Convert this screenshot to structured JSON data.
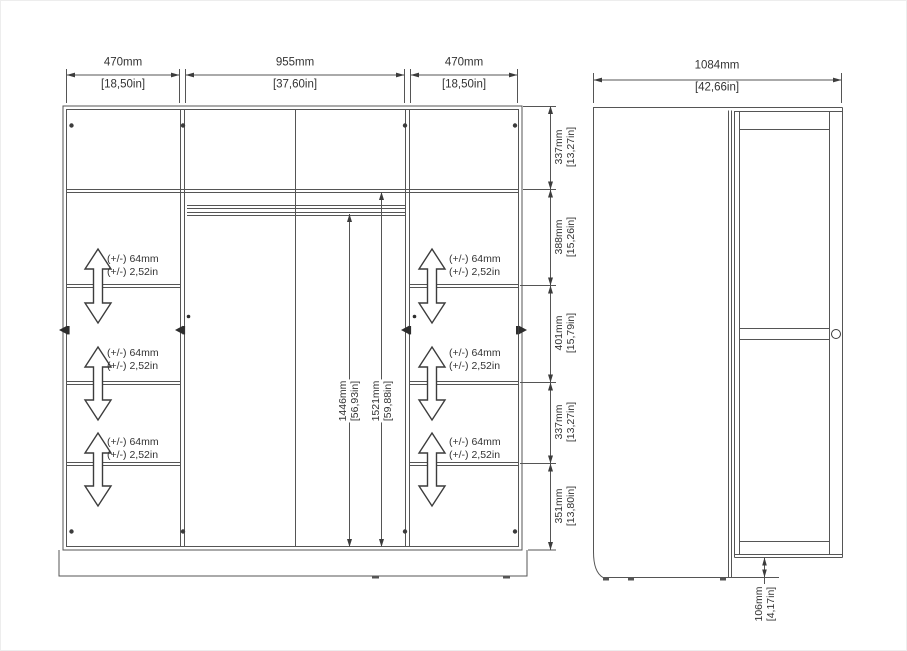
{
  "front_view": {
    "width_dims": [
      {
        "mm": "470mm",
        "inch": "[18,50in]"
      },
      {
        "mm": "955mm",
        "inch": "[37,60in]"
      },
      {
        "mm": "470mm",
        "inch": "[18,50in]"
      }
    ],
    "height_chain": [
      {
        "mm": "337mm",
        "inch": "[13,27in]"
      },
      {
        "mm": "388mm",
        "inch": "[15,26in]"
      },
      {
        "mm": "401mm",
        "inch": "[15,79in]"
      },
      {
        "mm": "337mm",
        "inch": "[13,27in]"
      },
      {
        "mm": "351mm",
        "inch": "[13,80in]"
      }
    ],
    "interior_dims": [
      {
        "mm": "1446mm",
        "inch": "[56,93in]"
      },
      {
        "mm": "1521mm",
        "inch": "[59,88in]"
      }
    ],
    "shelf_adjust": {
      "line1": "(+/-) 64mm",
      "line2": "(+/-) 2,52in"
    }
  },
  "side_view": {
    "depth_dim": {
      "mm": "1084mm",
      "inch": "[42,66in]"
    },
    "plinth_dim": {
      "mm": "106mm",
      "inch": "[4,17in]"
    }
  },
  "colors": {
    "line": "#555555",
    "text": "#333333",
    "background": "#ffffff"
  }
}
